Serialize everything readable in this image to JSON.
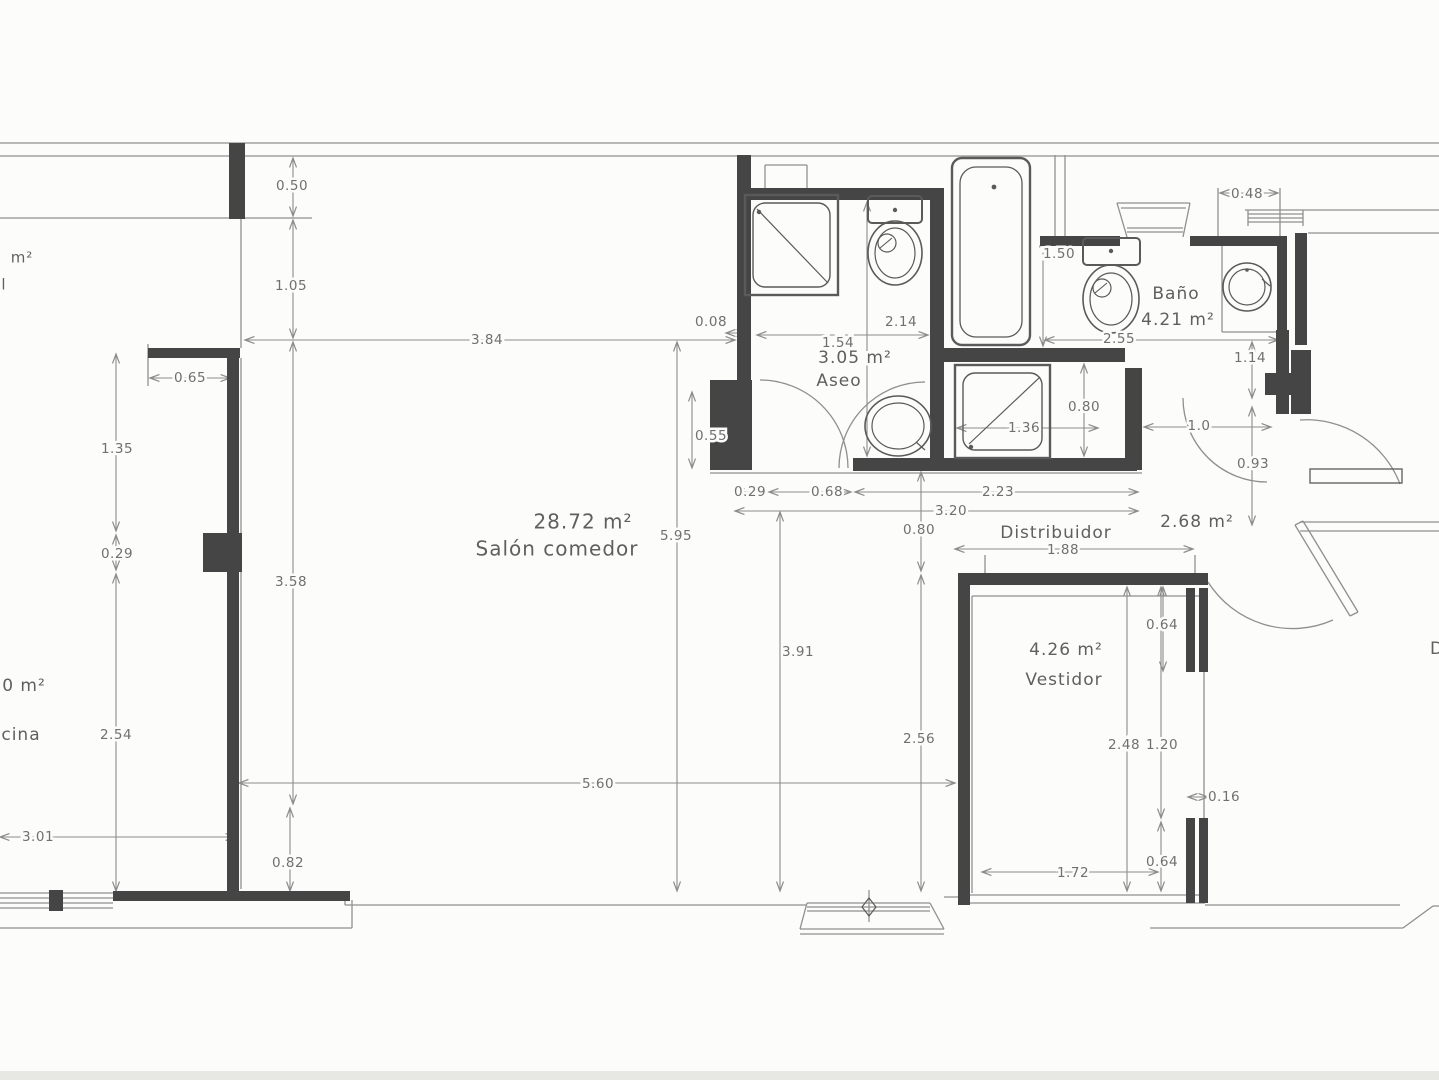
{
  "canvas": {
    "width": 1439,
    "height": 1080
  },
  "colors": {
    "background": "#fcfcfb",
    "wall": "#454545",
    "thin_line": "#8f8f8f",
    "dim_line": "#8c8c8c",
    "fixture": "#5a5a5a",
    "dim_text": "#707070",
    "room_text": "#5f5f5f",
    "scan_band": "#e7e7e4"
  },
  "labels": [
    {
      "t": "28.72 m²",
      "x": 583,
      "y": 523,
      "s": 20,
      "kind": "area"
    },
    {
      "t": "Salón comedor",
      "x": 557,
      "y": 550,
      "s": 20,
      "kind": "room"
    },
    {
      "t": "3.05 m²",
      "x": 855,
      "y": 358,
      "s": 17,
      "kind": "area"
    },
    {
      "t": "Aseo",
      "x": 839,
      "y": 381,
      "s": 17,
      "kind": "room"
    },
    {
      "t": "Baño",
      "x": 1176,
      "y": 294,
      "s": 17,
      "kind": "room"
    },
    {
      "t": "4.21 m²",
      "x": 1178,
      "y": 320,
      "s": 17,
      "kind": "area"
    },
    {
      "t": "Distribuidor",
      "x": 1056,
      "y": 533,
      "s": 17,
      "kind": "room"
    },
    {
      "t": "2.68 m²",
      "x": 1197,
      "y": 522,
      "s": 17,
      "kind": "area"
    },
    {
      "t": "4.26 m²",
      "x": 1066,
      "y": 650,
      "s": 17,
      "kind": "area"
    },
    {
      "t": "Vestidor",
      "x": 1064,
      "y": 680,
      "s": 17,
      "kind": "room"
    },
    {
      "t": "m²",
      "x": 22,
      "y": 258,
      "s": 15,
      "kind": "partial"
    },
    {
      "t": "l",
      "x": 4,
      "y": 285,
      "s": 15,
      "kind": "partial"
    },
    {
      "t": "0 m²",
      "x": 24,
      "y": 686,
      "s": 17,
      "kind": "partial"
    },
    {
      "t": "cina",
      "x": 21,
      "y": 735,
      "s": 17,
      "kind": "partial"
    },
    {
      "t": "D",
      "x": 1437,
      "y": 649,
      "s": 17,
      "kind": "partial"
    }
  ],
  "dim_labels": [
    {
      "t": "0.50",
      "x": 292,
      "y": 186
    },
    {
      "t": "1.05",
      "x": 291,
      "y": 286
    },
    {
      "t": "3.84",
      "x": 487,
      "y": 340
    },
    {
      "t": "0.65",
      "x": 190,
      "y": 378
    },
    {
      "t": "1.35",
      "x": 117,
      "y": 449
    },
    {
      "t": "0.29",
      "x": 117,
      "y": 554
    },
    {
      "t": "3.58",
      "x": 291,
      "y": 582
    },
    {
      "t": "2.54",
      "x": 116,
      "y": 735
    },
    {
      "t": "3.01",
      "x": 38,
      "y": 837
    },
    {
      "t": "0.82",
      "x": 288,
      "y": 863
    },
    {
      "t": "5.60",
      "x": 598,
      "y": 784
    },
    {
      "t": "5.95",
      "x": 676,
      "y": 536
    },
    {
      "t": "3.91",
      "x": 798,
      "y": 652
    },
    {
      "t": "2.56",
      "x": 919,
      "y": 739
    },
    {
      "t": "0.08",
      "x": 711,
      "y": 322
    },
    {
      "t": "1.54",
      "x": 838,
      "y": 343
    },
    {
      "t": "2.14",
      "x": 901,
      "y": 322
    },
    {
      "t": "0.55",
      "x": 711,
      "y": 436
    },
    {
      "t": "0.29",
      "x": 750,
      "y": 492
    },
    {
      "t": "0.68",
      "x": 827,
      "y": 492
    },
    {
      "t": "2.23",
      "x": 998,
      "y": 492
    },
    {
      "t": "3.20",
      "x": 951,
      "y": 511
    },
    {
      "t": "0.80",
      "x": 919,
      "y": 530
    },
    {
      "t": "1.88",
      "x": 1063,
      "y": 550
    },
    {
      "t": "0.64",
      "x": 1162,
      "y": 625
    },
    {
      "t": "2.48",
      "x": 1124,
      "y": 745
    },
    {
      "t": "1.20",
      "x": 1162,
      "y": 745
    },
    {
      "t": "0.16",
      "x": 1224,
      "y": 797
    },
    {
      "t": "0.64",
      "x": 1162,
      "y": 862
    },
    {
      "t": "1.72",
      "x": 1073,
      "y": 873
    },
    {
      "t": "1.50",
      "x": 1059,
      "y": 254
    },
    {
      "t": "2.55",
      "x": 1119,
      "y": 339
    },
    {
      "t": "0.48",
      "x": 1247,
      "y": 194
    },
    {
      "t": "1.14",
      "x": 1250,
      "y": 358
    },
    {
      "t": "1.36",
      "x": 1024,
      "y": 428
    },
    {
      "t": "0.80",
      "x": 1084,
      "y": 407
    },
    {
      "t": "1.0",
      "x": 1199,
      "y": 426
    },
    {
      "t": "0.93",
      "x": 1253,
      "y": 464
    }
  ],
  "walls": [
    [
      229,
      143,
      16,
      76
    ],
    [
      148,
      348,
      92,
      10
    ],
    [
      227,
      348,
      12,
      216
    ],
    [
      203,
      533,
      39,
      39
    ],
    [
      227,
      564,
      12,
      328
    ],
    [
      113,
      891,
      237,
      10
    ],
    [
      49,
      890,
      14,
      21
    ],
    [
      737,
      155,
      14,
      233
    ],
    [
      710,
      380,
      42,
      90
    ],
    [
      737,
      188,
      207,
      12
    ],
    [
      930,
      188,
      14,
      282
    ],
    [
      944,
      348,
      181,
      14
    ],
    [
      853,
      458,
      284,
      13
    ],
    [
      1125,
      368,
      17,
      102
    ],
    [
      1040,
      236,
      80,
      10
    ],
    [
      1190,
      236,
      97,
      10
    ],
    [
      1277,
      236,
      10,
      140
    ],
    [
      1265,
      373,
      34,
      22
    ],
    [
      1276,
      330,
      13,
      84
    ],
    [
      1291,
      350,
      20,
      64
    ],
    [
      1295,
      233,
      12,
      112
    ],
    [
      958,
      573,
      250,
      12
    ],
    [
      958,
      573,
      12,
      332
    ],
    [
      1186,
      588,
      9,
      84
    ],
    [
      1199,
      588,
      9,
      84
    ],
    [
      1186,
      818,
      9,
      85
    ],
    [
      1199,
      818,
      9,
      85
    ]
  ],
  "thin_lines": [
    [
      0,
      143,
      1439,
      143
    ],
    [
      0,
      156,
      1439,
      156
    ],
    [
      0,
      218,
      232,
      218
    ],
    [
      232,
      218,
      312,
      218
    ],
    [
      241,
      218,
      241,
      348
    ],
    [
      241,
      358,
      241,
      889
    ],
    [
      148,
      344,
      148,
      386
    ],
    [
      1245,
      210,
      1439,
      210
    ],
    [
      1308,
      233,
      1439,
      233
    ],
    [
      0,
      893,
      113,
      893
    ],
    [
      0,
      898,
      113,
      898
    ],
    [
      0,
      903,
      113,
      903
    ],
    [
      0,
      908,
      113,
      908
    ],
    [
      0,
      928,
      352,
      928
    ],
    [
      352,
      900,
      352,
      928
    ],
    [
      345,
      893,
      345,
      905
    ],
    [
      345,
      905,
      807,
      905
    ],
    [
      807,
      903,
      930,
      903
    ],
    [
      807,
      907,
      930,
      907
    ],
    [
      807,
      911,
      930,
      911
    ],
    [
      800,
      929,
      944,
      929
    ],
    [
      800,
      934,
      944,
      934
    ],
    [
      807,
      903,
      800,
      929
    ],
    [
      930,
      903,
      944,
      929
    ],
    [
      869,
      890,
      869,
      922
    ],
    [
      944,
      897,
      962,
      897
    ],
    [
      962,
      895,
      1205,
      895
    ],
    [
      962,
      903,
      1205,
      903
    ],
    [
      1205,
      905,
      1400,
      905
    ],
    [
      1150,
      928,
      1403,
      928
    ],
    [
      1403,
      928,
      1433,
      906
    ],
    [
      1433,
      906,
      1439,
      906
    ],
    [
      1300,
      522,
      1439,
      522
    ],
    [
      1300,
      531,
      1439,
      531
    ],
    [
      1295,
      525,
      1350,
      616
    ],
    [
      1303,
      521,
      1358,
      612
    ],
    [
      1295,
      525,
      1303,
      521
    ],
    [
      1350,
      616,
      1358,
      612
    ],
    [
      1055,
      155,
      1055,
      236
    ],
    [
      1065,
      155,
      1065,
      236
    ],
    [
      765,
      165,
      807,
      165
    ],
    [
      765,
      165,
      765,
      188
    ],
    [
      807,
      165,
      807,
      188
    ],
    [
      1117,
      203,
      1190,
      203
    ],
    [
      1121,
      208,
      1186,
      208
    ],
    [
      1117,
      203,
      1127,
      237
    ],
    [
      1190,
      203,
      1183,
      237
    ],
    [
      1127,
      228,
      1183,
      228
    ],
    [
      1127,
      232,
      1183,
      232
    ],
    [
      1248,
      214,
      1303,
      214
    ],
    [
      1248,
      218,
      1303,
      218
    ],
    [
      1248,
      222,
      1303,
      222
    ],
    [
      1248,
      210,
      1248,
      226
    ],
    [
      1303,
      210,
      1303,
      226
    ],
    [
      1222,
      246,
      1222,
      332
    ],
    [
      1222,
      332,
      1277,
      332
    ],
    [
      1218,
      188,
      1218,
      242
    ],
    [
      1280,
      188,
      1280,
      242
    ],
    [
      710,
      473,
      1142,
      473
    ],
    [
      972,
      596,
      1204,
      596
    ],
    [
      972,
      596,
      972,
      893
    ],
    [
      1204,
      588,
      1204,
      893
    ],
    [
      985,
      555,
      985,
      573
    ],
    [
      1195,
      555,
      1195,
      573
    ]
  ],
  "dim_lines": [
    [
      293,
      158,
      293,
      216
    ],
    [
      293,
      220,
      293,
      338
    ],
    [
      245,
      340,
      735,
      340
    ],
    [
      150,
      378,
      230,
      378
    ],
    [
      116,
      354,
      116,
      531
    ],
    [
      116,
      535,
      116,
      570
    ],
    [
      116,
      574,
      116,
      891
    ],
    [
      0,
      837,
      235,
      837
    ],
    [
      293,
      342,
      293,
      804
    ],
    [
      290,
      808,
      290,
      891
    ],
    [
      239,
      783,
      955,
      783
    ],
    [
      677,
      342,
      677,
      891
    ],
    [
      780,
      512,
      780,
      891
    ],
    [
      921,
      472,
      921,
      571
    ],
    [
      921,
      575,
      921,
      891
    ],
    [
      867,
      202,
      867,
      456
    ],
    [
      757,
      335,
      928,
      335
    ],
    [
      726,
      333,
      746,
      333
    ],
    [
      692,
      392,
      692,
      468
    ],
    [
      735,
      492,
      765,
      492
    ],
    [
      769,
      492,
      851,
      492
    ],
    [
      855,
      492,
      1138,
      492
    ],
    [
      735,
      511,
      1138,
      511
    ],
    [
      955,
      549,
      1193,
      549
    ],
    [
      1043,
      238,
      1043,
      346
    ],
    [
      1045,
      340,
      1278,
      340
    ],
    [
      1252,
      342,
      1252,
      398
    ],
    [
      1220,
      193,
      1278,
      193
    ],
    [
      1084,
      364,
      1084,
      456
    ],
    [
      957,
      428,
      1098,
      428
    ],
    [
      1144,
      427,
      1271,
      427
    ],
    [
      1252,
      407,
      1252,
      525
    ],
    [
      1163,
      587,
      1163,
      671
    ],
    [
      1127,
      587,
      1127,
      891
    ],
    [
      1161,
      587,
      1161,
      818
    ],
    [
      1161,
      822,
      1161,
      891
    ],
    [
      1188,
      797,
      1208,
      797
    ],
    [
      982,
      872,
      1158,
      872
    ]
  ],
  "arcs": [
    {
      "d": "M 760,380 A 88 88 0 0 1 848,468",
      "n": "door-arc-aseo"
    },
    {
      "d": "M 925,382 A 86 86 0 0 0 839,468",
      "n": "door-arc-aseo-2"
    },
    {
      "d": "M 1183,398 A 84 84 0 0 0 1267,482",
      "n": "door-arc-bano"
    },
    {
      "d": "M 1300,420 A 100 100 0 0 1 1400,484",
      "n": "door-arc-entrance"
    },
    {
      "d": "M 1208,582 A 100 100 0 0 0 1333,620",
      "n": "door-arc-hall"
    }
  ],
  "fixtures": [
    {
      "k": "rect",
      "p": [
        745,
        195,
        93,
        100
      ],
      "w": 2.4,
      "n": "shower-tray-aseo"
    },
    {
      "k": "rrect",
      "p": [
        753,
        203,
        77,
        84,
        12
      ],
      "w": 1.4,
      "n": "shower-tray-aseo-inner"
    },
    {
      "k": "line",
      "p": [
        757,
        209,
        828,
        283
      ],
      "w": 1.2,
      "n": "shower-diagonal"
    },
    {
      "k": "dot",
      "p": [
        759,
        212,
        2.2
      ],
      "n": "shower-drain"
    },
    {
      "k": "rrect",
      "p": [
        868,
        196,
        54,
        27,
        4
      ],
      "w": 2,
      "n": "toilet-tank-aseo"
    },
    {
      "k": "dot",
      "p": [
        895,
        210,
        2.2
      ],
      "n": "toilet-tank-button"
    },
    {
      "k": "ellipse",
      "p": [
        895,
        253,
        27,
        32
      ],
      "w": 1.6,
      "n": "toilet-bowl-aseo"
    },
    {
      "k": "ellipse",
      "p": [
        895,
        253,
        20,
        25
      ],
      "w": 1.2,
      "n": "toilet-bowl-aseo-inner"
    },
    {
      "k": "circle",
      "p": [
        887,
        243,
        9
      ],
      "w": 1.2,
      "n": "toilet-detail"
    },
    {
      "k": "line",
      "p": [
        880,
        248,
        892,
        238
      ],
      "w": 1.1,
      "n": "toilet-detail-line"
    },
    {
      "k": "rrect",
      "p": [
        952,
        158,
        78,
        187,
        10
      ],
      "w": 2.4,
      "n": "bathtub-outer"
    },
    {
      "k": "rrect",
      "p": [
        960,
        167,
        62,
        170,
        16
      ],
      "w": 1.3,
      "n": "bathtub-inner"
    },
    {
      "k": "dot",
      "p": [
        994,
        187,
        2.4
      ],
      "n": "bathtub-drain"
    },
    {
      "k": "rect",
      "p": [
        955,
        365,
        95,
        93
      ],
      "w": 2.4,
      "n": "shower-tray-bano"
    },
    {
      "k": "rrect",
      "p": [
        963,
        373,
        79,
        77,
        12
      ],
      "w": 1.4,
      "n": "shower-tray-bano-inner"
    },
    {
      "k": "line",
      "p": [
        969,
        444,
        1040,
        377
      ],
      "w": 1.2,
      "n": "shower-diagonal-2"
    },
    {
      "k": "dot",
      "p": [
        971,
        447,
        2.2
      ],
      "n": "shower-drain-2"
    },
    {
      "k": "rrect",
      "p": [
        1083,
        238,
        57,
        27,
        4
      ],
      "w": 2,
      "n": "toilet-tank-bano"
    },
    {
      "k": "dot",
      "p": [
        1111,
        251,
        2.2
      ],
      "n": "toilet-tank-button-2"
    },
    {
      "k": "ellipse",
      "p": [
        1111,
        299,
        28,
        34
      ],
      "w": 1.6,
      "n": "toilet-bowl-bano"
    },
    {
      "k": "ellipse",
      "p": [
        1111,
        299,
        21,
        26
      ],
      "w": 1.2,
      "n": "toilet-bowl-bano-inner"
    },
    {
      "k": "circle",
      "p": [
        1102,
        288,
        9
      ],
      "w": 1.2,
      "n": "toilet-detail-2"
    },
    {
      "k": "line",
      "p": [
        1095,
        293,
        1107,
        283
      ],
      "w": 1.1,
      "n": "toilet-detail-line-2"
    },
    {
      "k": "ellipse",
      "p": [
        898,
        426,
        33,
        30
      ],
      "w": 1.6,
      "n": "washbasin-aseo"
    },
    {
      "k": "ellipse",
      "p": [
        898,
        426,
        26,
        23
      ],
      "w": 1.2,
      "n": "washbasin-aseo-inner"
    },
    {
      "k": "line",
      "p": [
        916,
        442,
        925,
        450
      ],
      "w": 1.2,
      "n": "washbasin-spout"
    },
    {
      "k": "circle",
      "p": [
        1247,
        287,
        24
      ],
      "w": 1.6,
      "n": "washbasin-bano"
    },
    {
      "k": "circle",
      "p": [
        1247,
        287,
        18
      ],
      "w": 1.2,
      "n": "washbasin-bano-inner"
    },
    {
      "k": "line",
      "p": [
        1262,
        279,
        1270,
        286
      ],
      "w": 1.2,
      "n": "washbasin-spout-2"
    },
    {
      "k": "dot",
      "p": [
        1247,
        270,
        1.8
      ],
      "n": "washbasin-tap"
    },
    {
      "k": "rect",
      "p": [
        1310,
        469,
        92,
        14
      ],
      "w": 1.3,
      "n": "entrance-door-leaf"
    },
    {
      "k": "path",
      "p": "M 869,898 L 876,907 L 869,916 L 862,907 Z",
      "w": 1.2,
      "n": "section-marker"
    },
    {
      "k": "fill",
      "p": [
        0,
        1071,
        1439,
        9
      ],
      "n": "scan-edge-band"
    }
  ]
}
